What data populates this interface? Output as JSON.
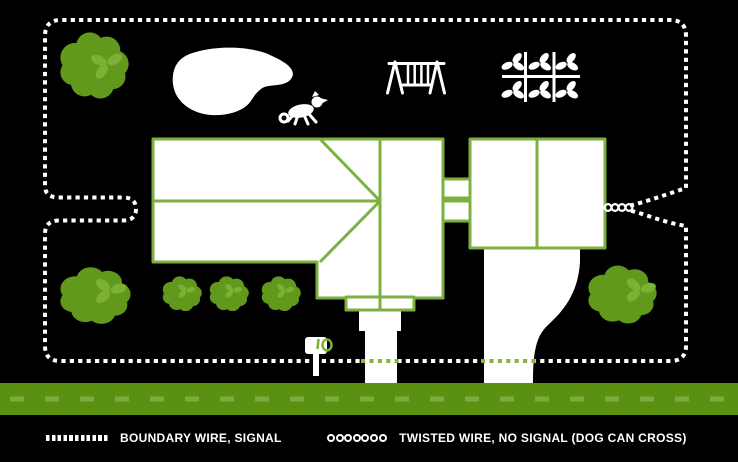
{
  "legend": {
    "items": [
      {
        "name": "boundary-wire",
        "swatch": "dashed-line-swatch",
        "label": "BOUNDARY WIRE, SIGNAL"
      },
      {
        "name": "twisted-wire",
        "swatch": "twisted-circles-swatch",
        "label": "TWISTED WIRE, NO SIGNAL (DOG CAN CROSS)"
      }
    ]
  },
  "colors": {
    "background": "#000000",
    "wire_white": "#ffffff",
    "house_outline_green": "#7cb13f",
    "tree_green": "#61991d",
    "leaf_green": "#7cb135",
    "road_green": "#5a9110",
    "road_marking_green": "#7caa43",
    "wire_over_pavement_green": "#8ab545"
  },
  "icons": {
    "tree-icon": "puffy green blob with leaf trefoil",
    "bush-icon": "small puffy green blob with leaf trefoil",
    "pond-icon": "white organic blob",
    "dog-icon": "white running dog silhouette",
    "swing-set-icon": "white A-frame swing set",
    "garden-icon": "white grid with six sprouts",
    "mailbox-icon": "white mailbox with green flag",
    "house-icon": "white roof-plan outline with hip roof, breezeway and garage"
  }
}
